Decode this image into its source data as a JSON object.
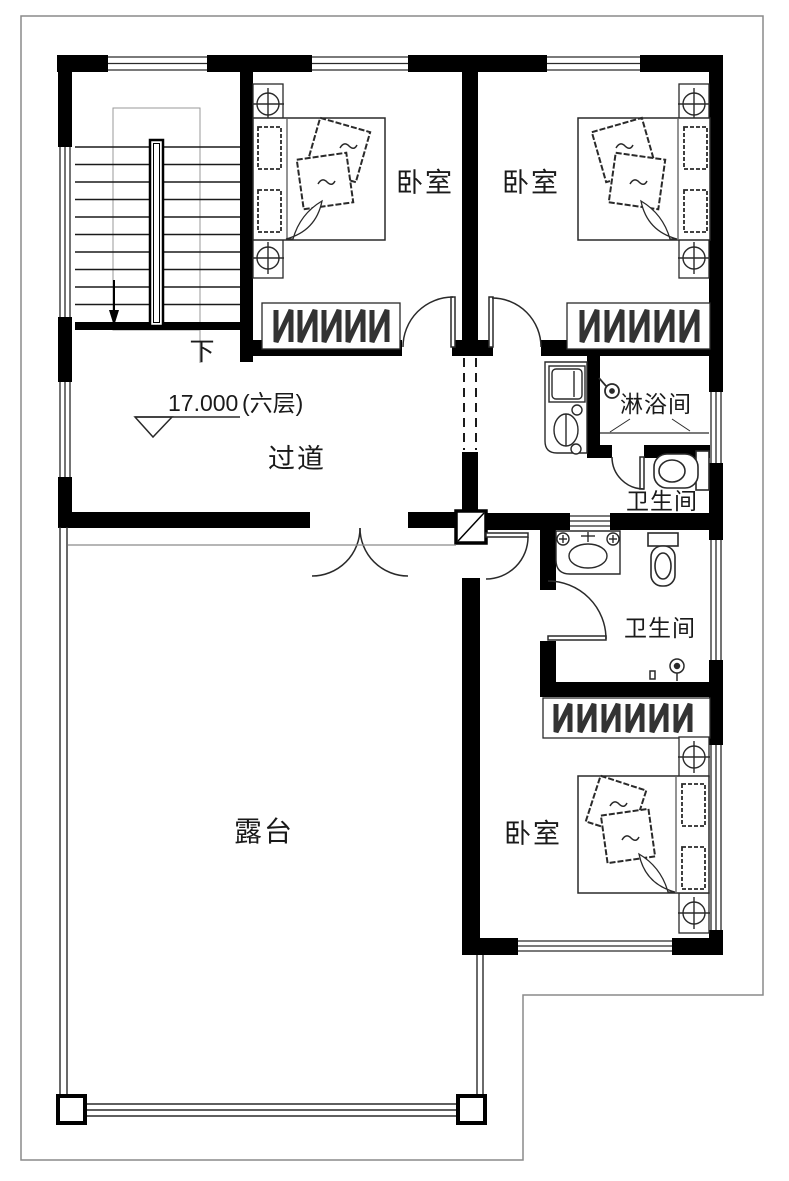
{
  "drawing": {
    "rooms": {
      "bedroom_top_left": "卧室",
      "bedroom_top_right": "卧室",
      "bedroom_bottom": "卧室",
      "corridor": "过道",
      "shower_room": "淋浴间",
      "bathroom_upper": "卫生间",
      "bathroom_lower": "卫生间",
      "terrace": "露台"
    },
    "stairs": {
      "direction_label": "下"
    },
    "elevation_marker": {
      "value": "17.000",
      "floor_label": "(六层)"
    },
    "colors": {
      "wall": "#000000",
      "line": "#2a2a2a",
      "guide": "#999999",
      "background": "#ffffff"
    }
  }
}
